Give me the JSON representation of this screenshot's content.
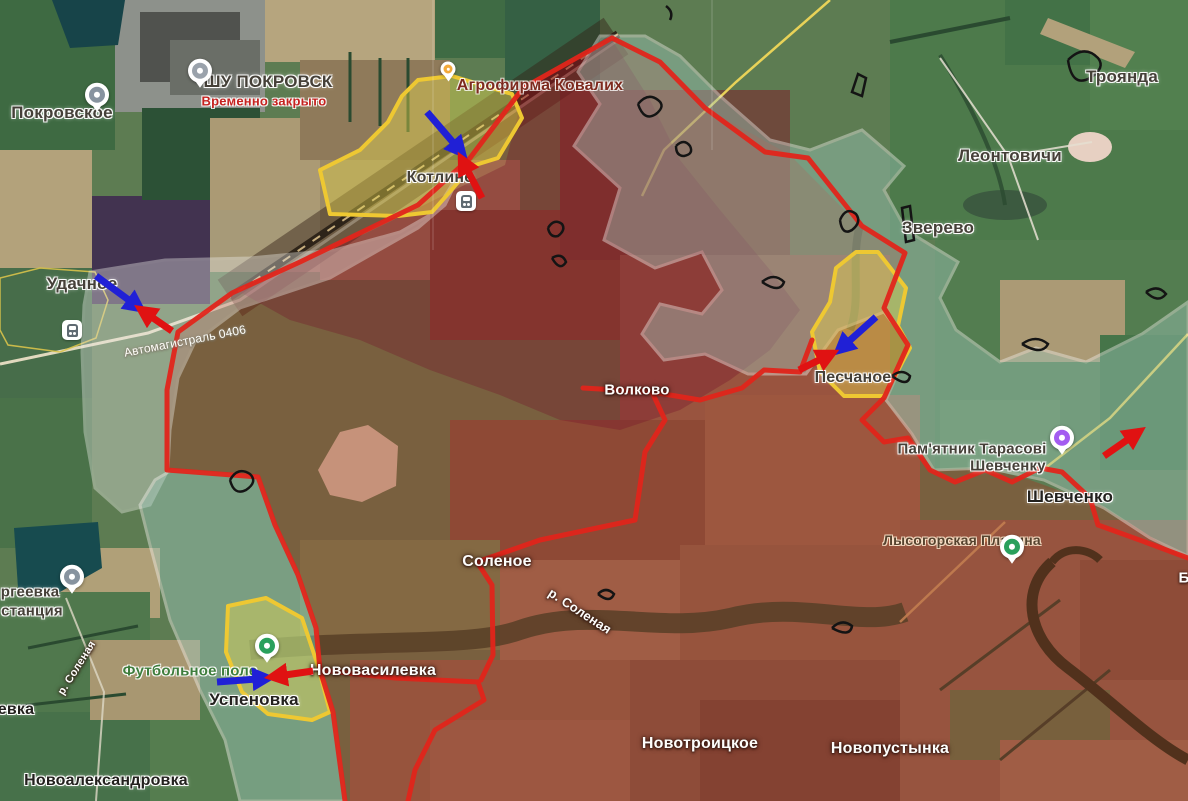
{
  "map": {
    "colors": {
      "front_line": "#e1251b",
      "blue_arrow": "#2020d6",
      "red_arrow": "#e01212",
      "yellow_zone_border": "#eec832",
      "contested_zone_border": "#f0f0ec",
      "red_zone_fill": "#b32619",
      "teal_zone_fill": "#9fc8bd"
    },
    "labels": [
      {
        "text": "Покровское",
        "x": 62,
        "y": 113,
        "style": "dark",
        "size": 17
      },
      {
        "text": "ШУ ПОКРОВСК",
        "x": 268,
        "y": 82,
        "style": "dark",
        "size": 17
      },
      {
        "text": "Временно закрыто",
        "x": 264,
        "y": 101,
        "style": "red",
        "size": 13
      },
      {
        "text": "Агрофирма Ковалих",
        "x": 540,
        "y": 86,
        "style": "maroon",
        "size": 16
      },
      {
        "text": "Котлине",
        "x": 440,
        "y": 178,
        "style": "dark",
        "size": 16
      },
      {
        "text": "Троянда",
        "x": 1122,
        "y": 77,
        "style": "dark",
        "size": 17
      },
      {
        "text": "Леонтовичи",
        "x": 1010,
        "y": 156,
        "style": "dark",
        "size": 17
      },
      {
        "text": "Зверево",
        "x": 938,
        "y": 228,
        "style": "dark",
        "size": 17
      },
      {
        "text": "Удачное",
        "x": 82,
        "y": 284,
        "style": "dark",
        "size": 17
      },
      {
        "text": "Автомагистраль 0406",
        "x": 185,
        "y": 341,
        "style": "road",
        "size": 12,
        "rotate": -11
      },
      {
        "text": "Волково",
        "x": 637,
        "y": 390,
        "style": "white",
        "size": 15
      },
      {
        "text": "Песчаное",
        "x": 853,
        "y": 378,
        "style": "dark",
        "size": 16
      },
      {
        "text": "Пам'ятник Тарасові",
        "x": 972,
        "y": 449,
        "style": "dark",
        "size": 15
      },
      {
        "text": "Шевченку",
        "x": 1008,
        "y": 466,
        "style": "dark",
        "size": 15
      },
      {
        "text": "Шевченко",
        "x": 1070,
        "y": 497,
        "style": "dark-bold",
        "size": 17
      },
      {
        "text": "Лысогорская Платина",
        "x": 962,
        "y": 540,
        "style": "brown",
        "size": 14
      },
      {
        "text": "Соленое",
        "x": 497,
        "y": 562,
        "style": "white",
        "size": 16
      },
      {
        "text": "р. Соленая",
        "x": 580,
        "y": 611,
        "style": "white",
        "size": 13,
        "rotate": 33
      },
      {
        "text": "р. Соленая",
        "x": 77,
        "y": 668,
        "style": "white",
        "size": 11,
        "rotate": -58
      },
      {
        "text": "Футбольное поле",
        "x": 190,
        "y": 671,
        "style": "green",
        "size": 15
      },
      {
        "text": "Нововасилевка",
        "x": 373,
        "y": 671,
        "style": "white",
        "size": 16
      },
      {
        "text": "Успеновка",
        "x": 254,
        "y": 700,
        "style": "dark-bold",
        "size": 17
      },
      {
        "text": "Новотроицкое",
        "x": 700,
        "y": 744,
        "style": "white",
        "size": 16
      },
      {
        "text": "Новопустынка",
        "x": 890,
        "y": 749,
        "style": "white",
        "size": 16
      },
      {
        "text": "Новоалександровка",
        "x": 106,
        "y": 781,
        "style": "dark-bold",
        "size": 16
      },
      {
        "text": "ргеевка",
        "x": 30,
        "y": 592,
        "style": "dark",
        "size": 15
      },
      {
        "text": "станция",
        "x": 32,
        "y": 611,
        "style": "dark",
        "size": 15
      },
      {
        "text": "евка",
        "x": 16,
        "y": 710,
        "style": "dark-bold",
        "size": 16
      },
      {
        "text": "Б",
        "x": 1184,
        "y": 578,
        "style": "white-bold",
        "size": 15
      }
    ],
    "pins": [
      {
        "name": "pokrovskoe-pin",
        "type": "round",
        "color": "#87939f",
        "x": 97,
        "y": 112
      },
      {
        "name": "shu-pokrovsk-pin",
        "type": "round",
        "color": "#9aa2ab",
        "x": 200,
        "y": 88
      },
      {
        "name": "agrofirma-pin",
        "type": "dot",
        "color": "#f2a93b",
        "x": 448,
        "y": 83
      },
      {
        "name": "kotline-station-icon",
        "type": "station",
        "x": 466,
        "y": 201
      },
      {
        "name": "udachnoe-station-icon",
        "type": "station",
        "x": 72,
        "y": 330
      },
      {
        "name": "sergeevka-pin",
        "type": "round",
        "color": "#87939f",
        "x": 72,
        "y": 594
      },
      {
        "name": "lysogorka-pin",
        "type": "round",
        "color": "#2aa05c",
        "x": 1012,
        "y": 564
      },
      {
        "name": "pamyatnik-pin",
        "type": "round",
        "color": "#a35cf0",
        "x": 1062,
        "y": 455
      },
      {
        "name": "football-field-pin",
        "type": "round",
        "color": "#2aa05c",
        "x": 267,
        "y": 663
      }
    ],
    "arrows": [
      {
        "name": "advance-arrow-blue-kotline",
        "color": "blue",
        "x1": 427,
        "y1": 112,
        "x2": 463,
        "y2": 154
      },
      {
        "name": "advance-arrow-red-kotline",
        "color": "red",
        "x1": 482,
        "y1": 198,
        "x2": 461,
        "y2": 158
      },
      {
        "name": "advance-arrow-blue-udachnoe",
        "color": "blue",
        "x1": 96,
        "y1": 276,
        "x2": 141,
        "y2": 309
      },
      {
        "name": "advance-arrow-red-udachnoe",
        "color": "red",
        "x1": 172,
        "y1": 331,
        "x2": 140,
        "y2": 309
      },
      {
        "name": "advance-arrow-blue-peschanoe",
        "color": "blue",
        "x1": 876,
        "y1": 317,
        "x2": 838,
        "y2": 351
      },
      {
        "name": "advance-arrow-red-peschanoe",
        "color": "red",
        "x1": 799,
        "y1": 370,
        "x2": 833,
        "y2": 353
      },
      {
        "name": "advance-arrow-blue-uspenovka",
        "color": "blue",
        "x1": 217,
        "y1": 682,
        "x2": 269,
        "y2": 678
      },
      {
        "name": "advance-arrow-red-uspenovka",
        "color": "red",
        "x1": 313,
        "y1": 671,
        "x2": 271,
        "y2": 677
      },
      {
        "name": "advance-arrow-red-shevchenko",
        "color": "red",
        "x1": 1104,
        "y1": 456,
        "x2": 1140,
        "y2": 431
      }
    ]
  }
}
